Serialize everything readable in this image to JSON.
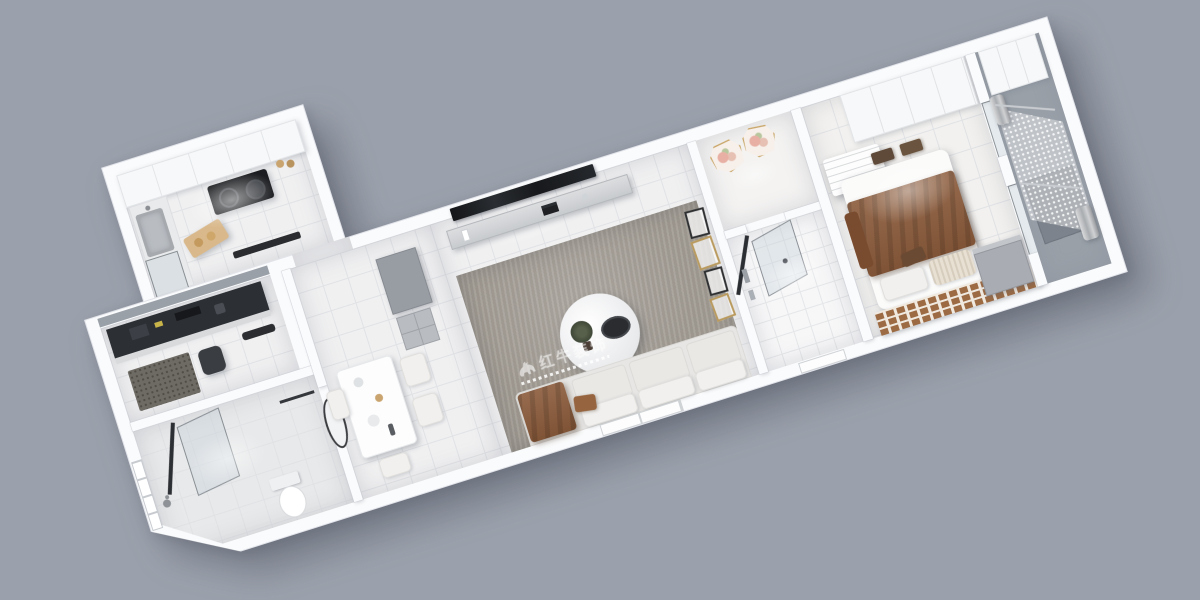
{
  "scene": {
    "description": "3D axonometric render of a long one-bedroom apartment floor plan on a plain gray background",
    "background": "#9ba1ac"
  },
  "watermark": {
    "icon": "bull-icon",
    "text": "红牛装饰",
    "color": "#ffffff"
  },
  "palette": {
    "bg": "#9ba1ac",
    "wall": "#fafbfc",
    "floor": "#f0f0f1",
    "floor-line": "#e0e2e5",
    "sill": "#9aa0a8",
    "rug": "#a39d95",
    "dark": "#26282c",
    "steel": "#b9bdc2",
    "brick": "#9c6b44",
    "mortar": "#f0e9e0",
    "blanket": "#8a5a3a",
    "balcony": "#99a0a8"
  },
  "rooms": [
    {
      "id": "kitchen",
      "furniture": [
        "upper-cabinets",
        "steel-sink",
        "black-cooktop",
        "cutting-board",
        "coffee-cups",
        "hood-vent"
      ]
    },
    {
      "id": "study-nook",
      "furniture": [
        "dark-desk",
        "desk-chair",
        "speckled-mat",
        "window-sill"
      ]
    },
    {
      "id": "bathroom",
      "furniture": [
        "framed-window",
        "glass-shower-door",
        "toilet",
        "shower-head",
        "towel-bar"
      ]
    },
    {
      "id": "dining-area",
      "furniture": [
        "dining-table",
        "chairs",
        "oval-mirror",
        "gray-cabinet",
        "shelf-unit"
      ]
    },
    {
      "id": "living-room",
      "furniture": [
        "wall-tv",
        "floating-console",
        "gray-rug",
        "round-coffee-table",
        "plant",
        "sofa",
        "brown-throw",
        "picture-frames",
        "window"
      ]
    },
    {
      "id": "entry-hall",
      "furniture": [
        "floral-plate",
        "floral-plate"
      ]
    },
    {
      "id": "shower-room",
      "furniture": [
        "glass-pivot-door",
        "tile-floor",
        "window"
      ]
    },
    {
      "id": "bedroom",
      "furniture": [
        "wardrobe",
        "ceiling-ac-unit",
        "double-bed",
        "brown-blanket",
        "pillows",
        "brick-accent-wall",
        "dresser",
        "foot-stools"
      ]
    },
    {
      "id": "balcony",
      "furniture": [
        "tall-cabinet",
        "sheer-curtain",
        "curtain-bunches",
        "floor-mat"
      ]
    }
  ]
}
